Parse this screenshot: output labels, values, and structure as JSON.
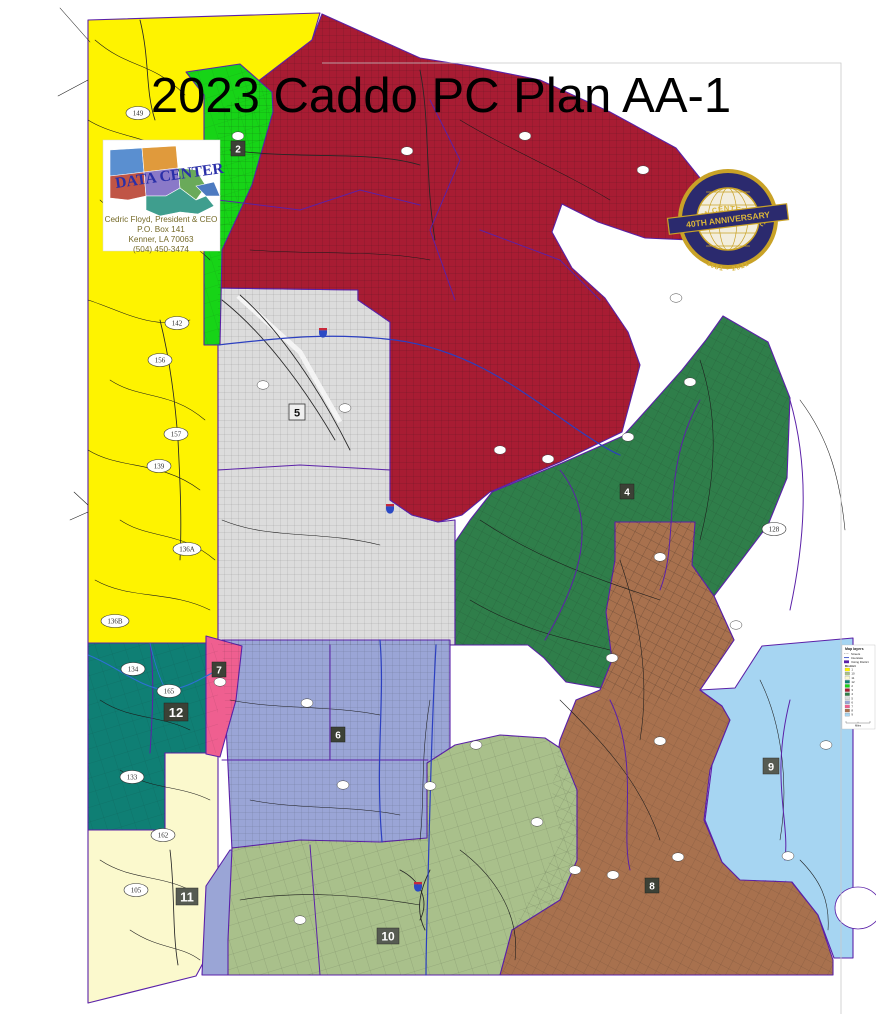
{
  "title": "2023 Caddo PC Plan AA-1",
  "logo": {
    "brand": "DATA CENTER",
    "contact_lines": [
      "Cedric Floyd, President & CEO",
      "P.O. Box 141",
      "Kenner, LA  70063",
      "(504) 450-3474"
    ]
  },
  "badge": {
    "top_arc": "DATA CENTER, LLC",
    "ribbon": "40TH ANNIVERSARY",
    "bottom_arc": "1981 - 2021"
  },
  "legend": {
    "title": "Map layers",
    "line_items": [
      {
        "label": "Streets",
        "color": "#8c8c8c"
      },
      {
        "label": "Interstate",
        "color": "#3a4fc8"
      },
      {
        "label": "Voting District",
        "color": "#5b21a8"
      }
    ],
    "district_header": "District",
    "districts": [
      {
        "number": "1",
        "color": "#fef300"
      },
      {
        "number": "10",
        "color": "#a9c08b"
      },
      {
        "number": "11",
        "color": "#fbf9cd"
      },
      {
        "number": "12",
        "color": "#0f7f74"
      },
      {
        "number": "2",
        "color": "#17d417"
      },
      {
        "number": "3",
        "color": "#a81c33"
      },
      {
        "number": "4",
        "color": "#2f7e4a"
      },
      {
        "number": "5",
        "color": "#dcdcdc"
      },
      {
        "number": "6",
        "color": "#9aa5d6"
      },
      {
        "number": "7",
        "color": "#ef5f90"
      },
      {
        "number": "8",
        "color": "#a8714e"
      },
      {
        "number": "9",
        "color": "#a6d5f2"
      }
    ],
    "scale_label": "Miles"
  },
  "district_colors": {
    "d1": "#fef300",
    "d2": "#17d417",
    "d3": "#a81c33",
    "d4": "#2f7e4a",
    "d5": "#dcdcdc",
    "d6": "#9aa5d6",
    "d7": "#ef5f90",
    "d8": "#a8714e",
    "d9": "#a6d5f2",
    "d10": "#a9c08b",
    "d11": "#fbf9cd",
    "d12": "#0f7f74"
  },
  "district_labels": [
    {
      "number": "2"
    },
    {
      "number": "4"
    },
    {
      "number": "5"
    },
    {
      "number": "6"
    },
    {
      "number": "7"
    },
    {
      "number": "8"
    },
    {
      "number": "9"
    },
    {
      "number": "10"
    },
    {
      "number": "11"
    },
    {
      "number": "12"
    }
  ],
  "road_shields": [
    {
      "number": "149"
    },
    {
      "number": "142"
    },
    {
      "number": "156"
    },
    {
      "number": "157"
    },
    {
      "number": "139"
    },
    {
      "number": "136A"
    },
    {
      "number": "136B"
    },
    {
      "number": "134"
    },
    {
      "number": "165"
    },
    {
      "number": "133"
    },
    {
      "number": "162"
    },
    {
      "number": "105"
    },
    {
      "number": "128"
    }
  ]
}
